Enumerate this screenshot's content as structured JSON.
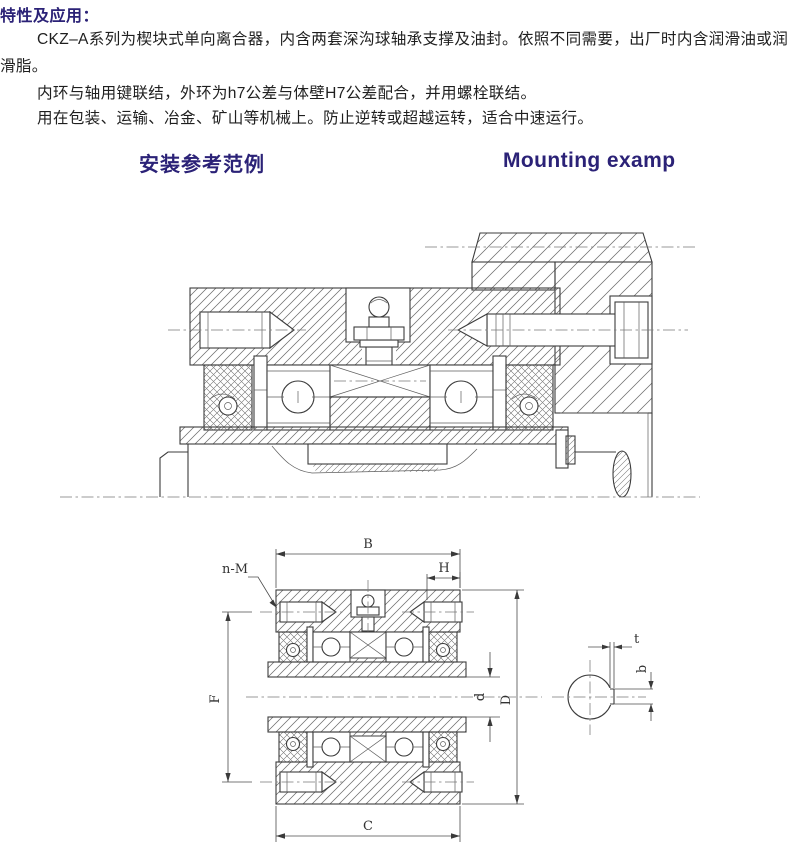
{
  "document": {
    "section_title": "特性及应用：",
    "lines": [
      {
        "text": "CKZ–A系列为楔块式单向离合器，内含两套深沟球轴承支撑及油封。依照不同需要，出厂时内含润滑油或润",
        "indent": true
      },
      {
        "text": "滑脂。",
        "indent": false
      },
      {
        "text": "内环与轴用键联结，外环为h7公差与体壁H7公差配合，并用螺栓联结。",
        "indent": true
      },
      {
        "text": "用在包装、运输、冶金、矿山等机械上。防止逆转或超越运转，适合中速运行。",
        "indent": true
      }
    ],
    "heading_zh": "安装参考范例",
    "heading_en": "Mounting examp"
  },
  "drawing": {
    "labels": {
      "B": "B",
      "H": "H",
      "n_M": "n-M",
      "F": "F",
      "d": "d",
      "D": "D",
      "C": "C",
      "t": "t",
      "b": "b"
    }
  },
  "colors": {
    "heading": "#2b2277",
    "body_text": "#1f1f1f",
    "drawing_line": "#3c3c3c"
  }
}
